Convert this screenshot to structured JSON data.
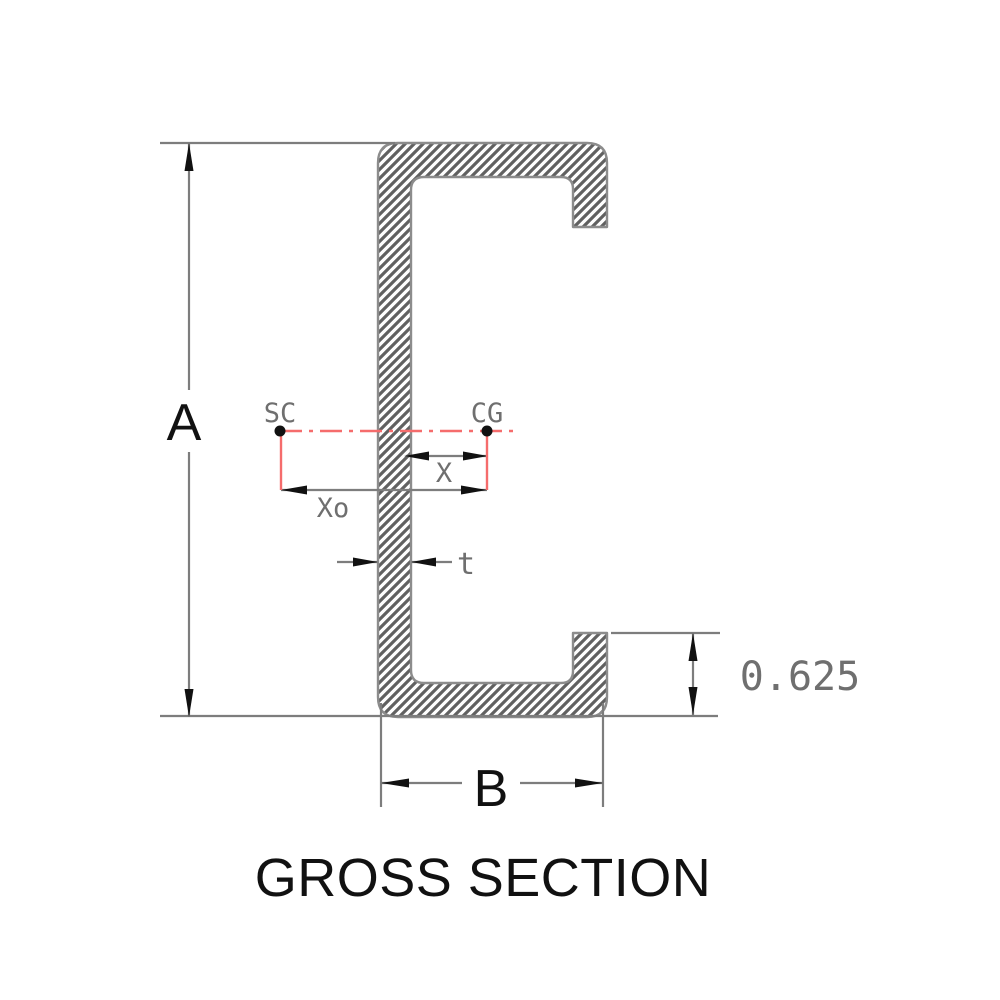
{
  "title": "GROSS SECTION",
  "labels": {
    "depth": "A",
    "flange_width": "B",
    "lip_length": "0.625",
    "thickness": "t",
    "cg_offset": "X",
    "shear_center_offset": "Xo",
    "shear_center": "SC",
    "center_of_gravity": "CG"
  },
  "colors": {
    "background": "#ffffff",
    "ink": "#111111",
    "dimension": "#7d7d7d",
    "outline": "#8c8c8c",
    "hatch": "#616161",
    "label_gray": "#6f6f6f",
    "centerline": "#f56c6c"
  }
}
